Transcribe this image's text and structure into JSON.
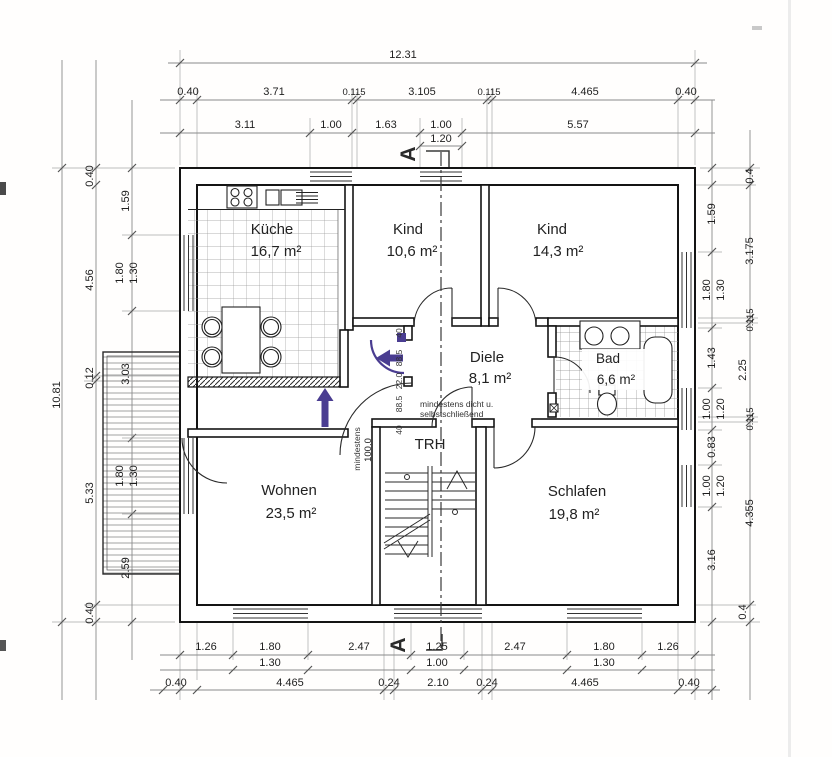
{
  "rooms": {
    "kueche": {
      "name": "Küche",
      "area": "16,7 m²"
    },
    "kind1": {
      "name": "Kind",
      "area": "10,6 m²"
    },
    "kind2": {
      "name": "Kind",
      "area": "14,3 m²"
    },
    "diele": {
      "name": "Diele",
      "area": "8,1 m²"
    },
    "bad": {
      "name": "Bad",
      "area": "6,6 m²"
    },
    "wohnen": {
      "name": "Wohnen",
      "area": "23,5 m²"
    },
    "schlafen": {
      "name": "Schlafen",
      "area": "19,8 m²"
    },
    "trh": {
      "name": "TRH"
    }
  },
  "annotations": {
    "door_note_line1": "mindestens dicht u.",
    "door_note_line2": "selbstschließend",
    "min_label": "mindestens",
    "min_value": "100.0",
    "section_letter": "A"
  },
  "dims": {
    "top_total": "12.31",
    "top_row2": [
      "0.40",
      "3.71",
      "0.115",
      "3.105",
      "0.115",
      "4.465",
      "0.40"
    ],
    "top_row3": [
      "3.11",
      "1.00",
      "1.63",
      "1.00",
      "5.57"
    ],
    "top_section": "1.20",
    "bottom_row1": [
      "1.26",
      "1.80",
      "2.47",
      "1.25",
      "2.47",
      "1.80",
      "1.26"
    ],
    "bottom_row2": [
      "1.30",
      "1.00",
      "1.30"
    ],
    "bottom_row3": [
      "0.40",
      "4.465",
      "0.24",
      "2.10",
      "0.24",
      "4.465",
      "0.40"
    ],
    "left_total": "10.81",
    "left_mid": [
      "0.40",
      "4.56",
      "0.12",
      "5.33",
      "0.40"
    ],
    "left_inner": [
      "1.59",
      "1.80",
      "1.30",
      "3.03",
      "1.80",
      "1.30",
      "2.59"
    ],
    "right_inner": [
      "1.59",
      "1.80",
      "1.30",
      "1.43",
      "1.00",
      "1.20",
      "0.83",
      "1.00",
      "1.20",
      "3.16"
    ],
    "right_outer": [
      "0.4",
      "3.175",
      "0.115",
      "2.25",
      "0.115",
      "4.355",
      "0.4"
    ],
    "door_chain": [
      "40",
      "88.5",
      "22.0",
      "88.5",
      "40"
    ]
  }
}
